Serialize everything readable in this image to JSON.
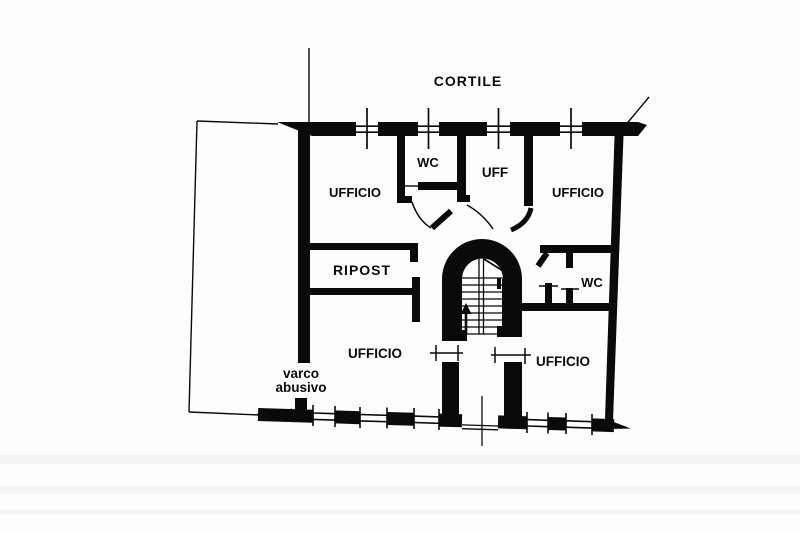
{
  "document": {
    "kind": "cadastral-floor-plan-scan",
    "ink_color": "#0a0a0a",
    "paper_color": "#fdfdfc"
  },
  "labels": {
    "cortile": "CORTILE",
    "ufficio_top_left": "UFFICIO",
    "wc_top": "WC",
    "uff": "UFF",
    "ufficio_top_right": "UFFICIO",
    "ripost": "RIPOST",
    "wc_right": "WC",
    "ufficio_bottom_left": "UFFICIO",
    "ufficio_bottom_right": "UFFICIO",
    "varco_abusivo": {
      "line1": "varco",
      "line2": "abusivo"
    }
  }
}
